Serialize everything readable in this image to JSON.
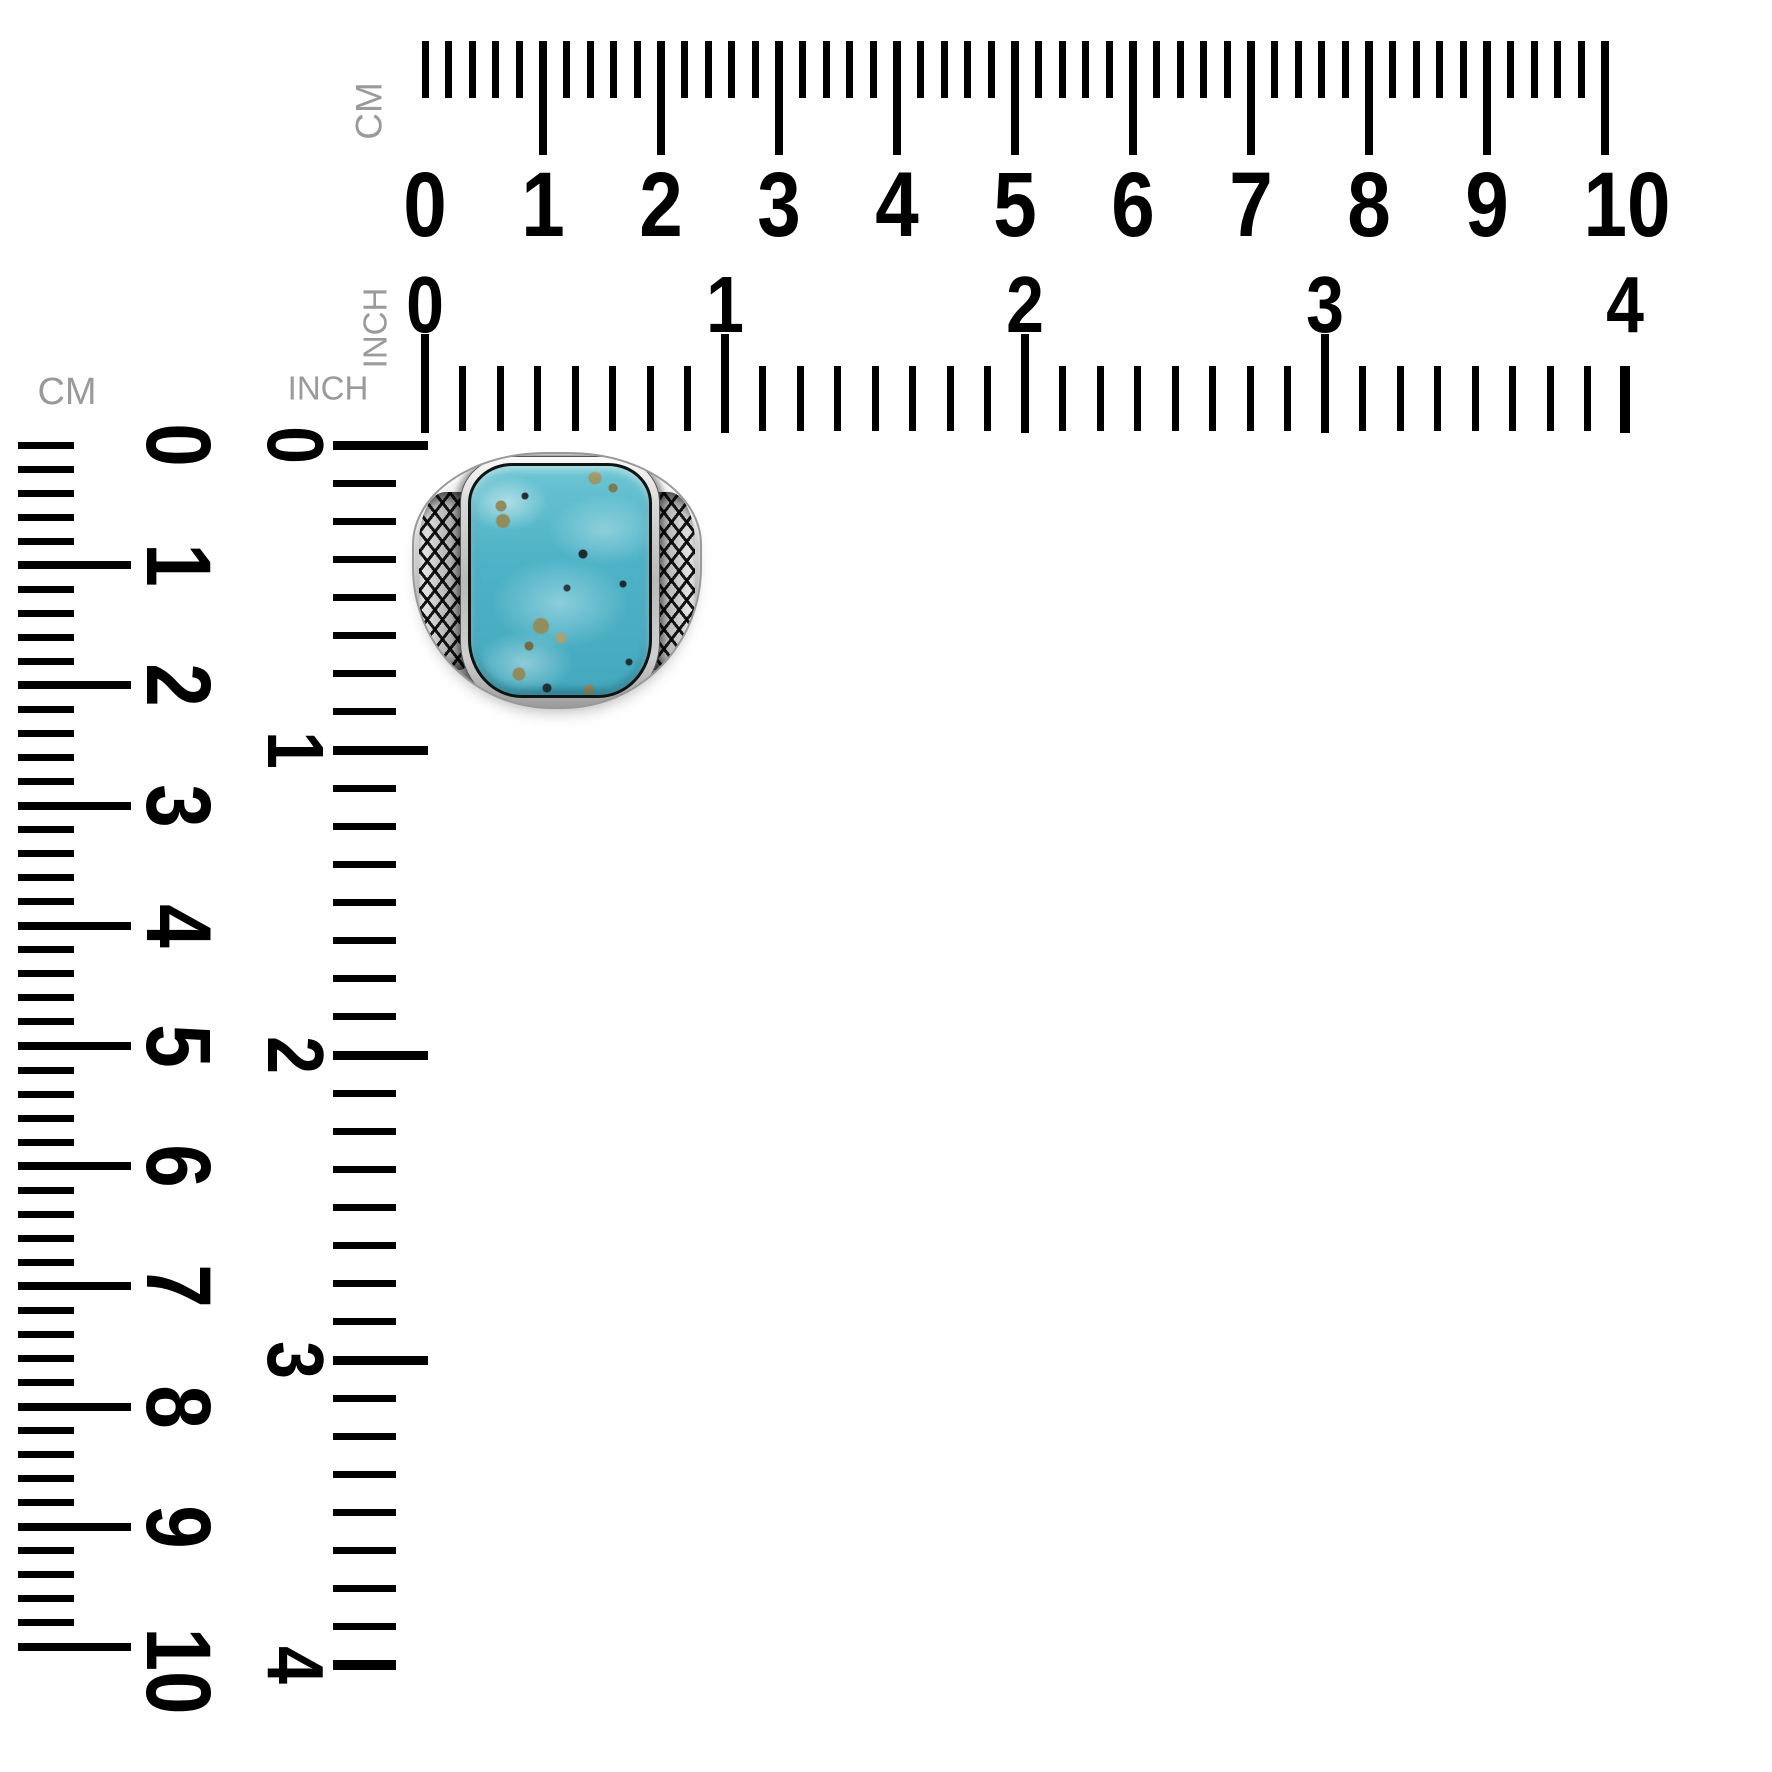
{
  "background_color": "#ffffff",
  "rulers": {
    "top_cm": {
      "unit_label": "CM",
      "numbers": [
        "0",
        "1",
        "2",
        "3",
        "4",
        "5",
        "6",
        "7",
        "8",
        "9",
        "10"
      ]
    },
    "top_inch": {
      "unit_label": "INCH",
      "numbers": [
        "0",
        "1",
        "2",
        "3",
        "4"
      ]
    },
    "left_cm": {
      "unit_label": "CM",
      "numbers": [
        "0",
        "1",
        "2",
        "3",
        "4",
        "5",
        "6",
        "7",
        "8",
        "9",
        "10"
      ]
    },
    "left_inch": {
      "unit_label": "INCH",
      "numbers": [
        "0",
        "1",
        "2",
        "3",
        "4"
      ]
    }
  },
  "colors": {
    "tick": "#000000",
    "unit_label": "#9a9a9a",
    "stone_turquoise": "#4fb3c7",
    "stone_highlight": "#c9ecef",
    "pyrite_fleck": "#8f8c60",
    "silver_band": "#cfcfcf",
    "oxidized_crosshatch": "#141414"
  }
}
